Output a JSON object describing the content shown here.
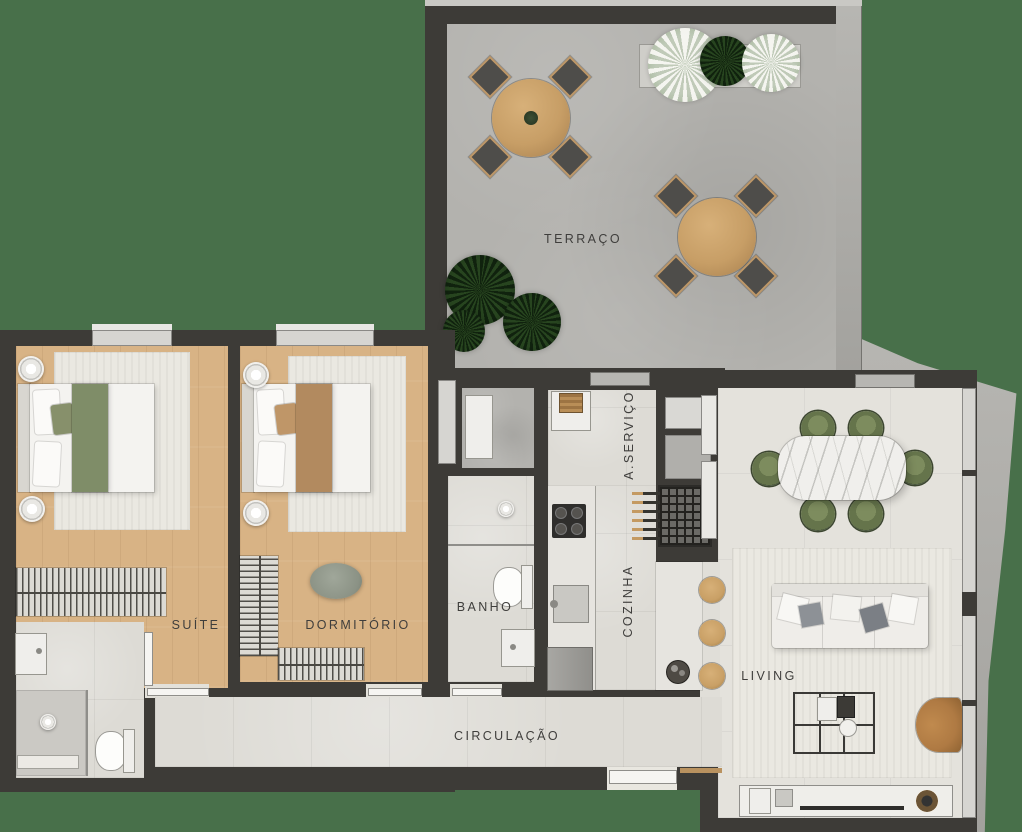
{
  "rooms": [
    {
      "id": "terraco",
      "label": "TERRAÇO"
    },
    {
      "id": "suite",
      "label": "SUÍTE"
    },
    {
      "id": "dormitorio",
      "label": "DORMITÓRIO"
    },
    {
      "id": "banho",
      "label": "BANHO"
    },
    {
      "id": "servico",
      "label": "A.SERVIÇO"
    },
    {
      "id": "cozinha",
      "label": "COZINHA"
    },
    {
      "id": "living",
      "label": "LIVING"
    },
    {
      "id": "circulacao",
      "label": "CIRCULAÇÃO"
    }
  ],
  "colors": {
    "background_green": "#48704A",
    "wall_dark": "#3D3B37",
    "wood_floor": "#D8B385",
    "concrete_floor": "#B3B2AE",
    "tile_floor": "#DDDBD5",
    "living_floor": "#E4E2DC",
    "rug": "#EAE8E1",
    "bed_green": "#7F8D68",
    "bed_tan": "#B28A5F",
    "chair_olive": "#6E7D51",
    "terrace_table_wood": "#C79E66",
    "stool_wood": "#C9A066",
    "armchair_tan": "#AF7A43",
    "marble_white": "#F0EFEC",
    "label_text": "#3F3E3C"
  }
}
